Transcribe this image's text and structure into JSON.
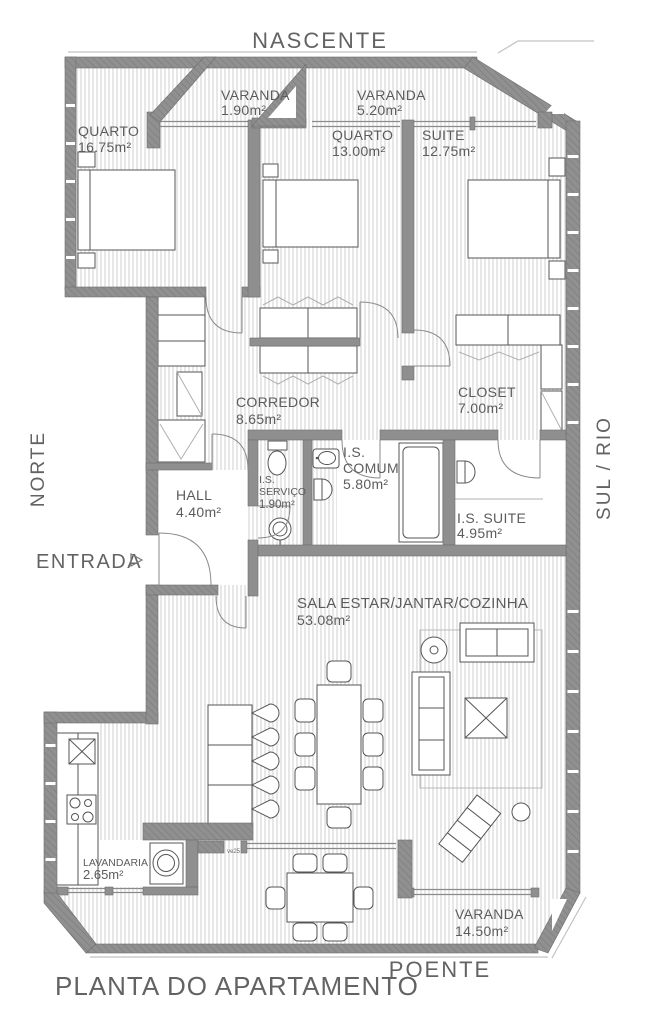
{
  "meta": {
    "title": "PLANTA DO APARTAMENTO"
  },
  "compass": {
    "top": "NASCENTE",
    "left": "NORTE",
    "right": "SUL / RIO",
    "bottom": "POENTE"
  },
  "entrance": {
    "label": "ENTRADA"
  },
  "annotations": {
    "window_code": "ve25"
  },
  "rooms": {
    "varanda_nascente_1": {
      "name": "VARANDA",
      "area": "1.90m²"
    },
    "varanda_nascente_2": {
      "name": "VARANDA",
      "area": "5.20m²"
    },
    "quarto_1": {
      "name": "QUARTO",
      "area": "16.75m²"
    },
    "quarto_2": {
      "name": "QUARTO",
      "area": "13.00m²"
    },
    "suite": {
      "name": "SUITE",
      "area": "12.75m²"
    },
    "closet": {
      "name": "CLOSET",
      "area": "7.00m²"
    },
    "corredor": {
      "name": "CORREDOR",
      "area": "8.65m²"
    },
    "hall": {
      "name": "HALL",
      "area": "4.40m²"
    },
    "is_servico": {
      "line1": "I.S.",
      "line2": "SERVIÇO",
      "area": "1.90m²"
    },
    "is_comum": {
      "line1": "I.S.",
      "line2": "COMUM",
      "area": "5.80m²"
    },
    "is_suite": {
      "name": "I.S. SUITE",
      "area": "4.95m²"
    },
    "sala": {
      "name": "SALA ESTAR/JANTAR/COZINHA",
      "area": "53.08m²"
    },
    "lavandaria": {
      "name": "LAVANDARIA",
      "area": "2.65m²"
    },
    "varanda_poente": {
      "name": "VARANDA",
      "area": "14.50m²"
    }
  },
  "colors": {
    "wall": "#8f8f8f",
    "floor_hatch": "#cfcfcf",
    "text": "#5c5c5c",
    "furniture_stroke": "#555555"
  }
}
